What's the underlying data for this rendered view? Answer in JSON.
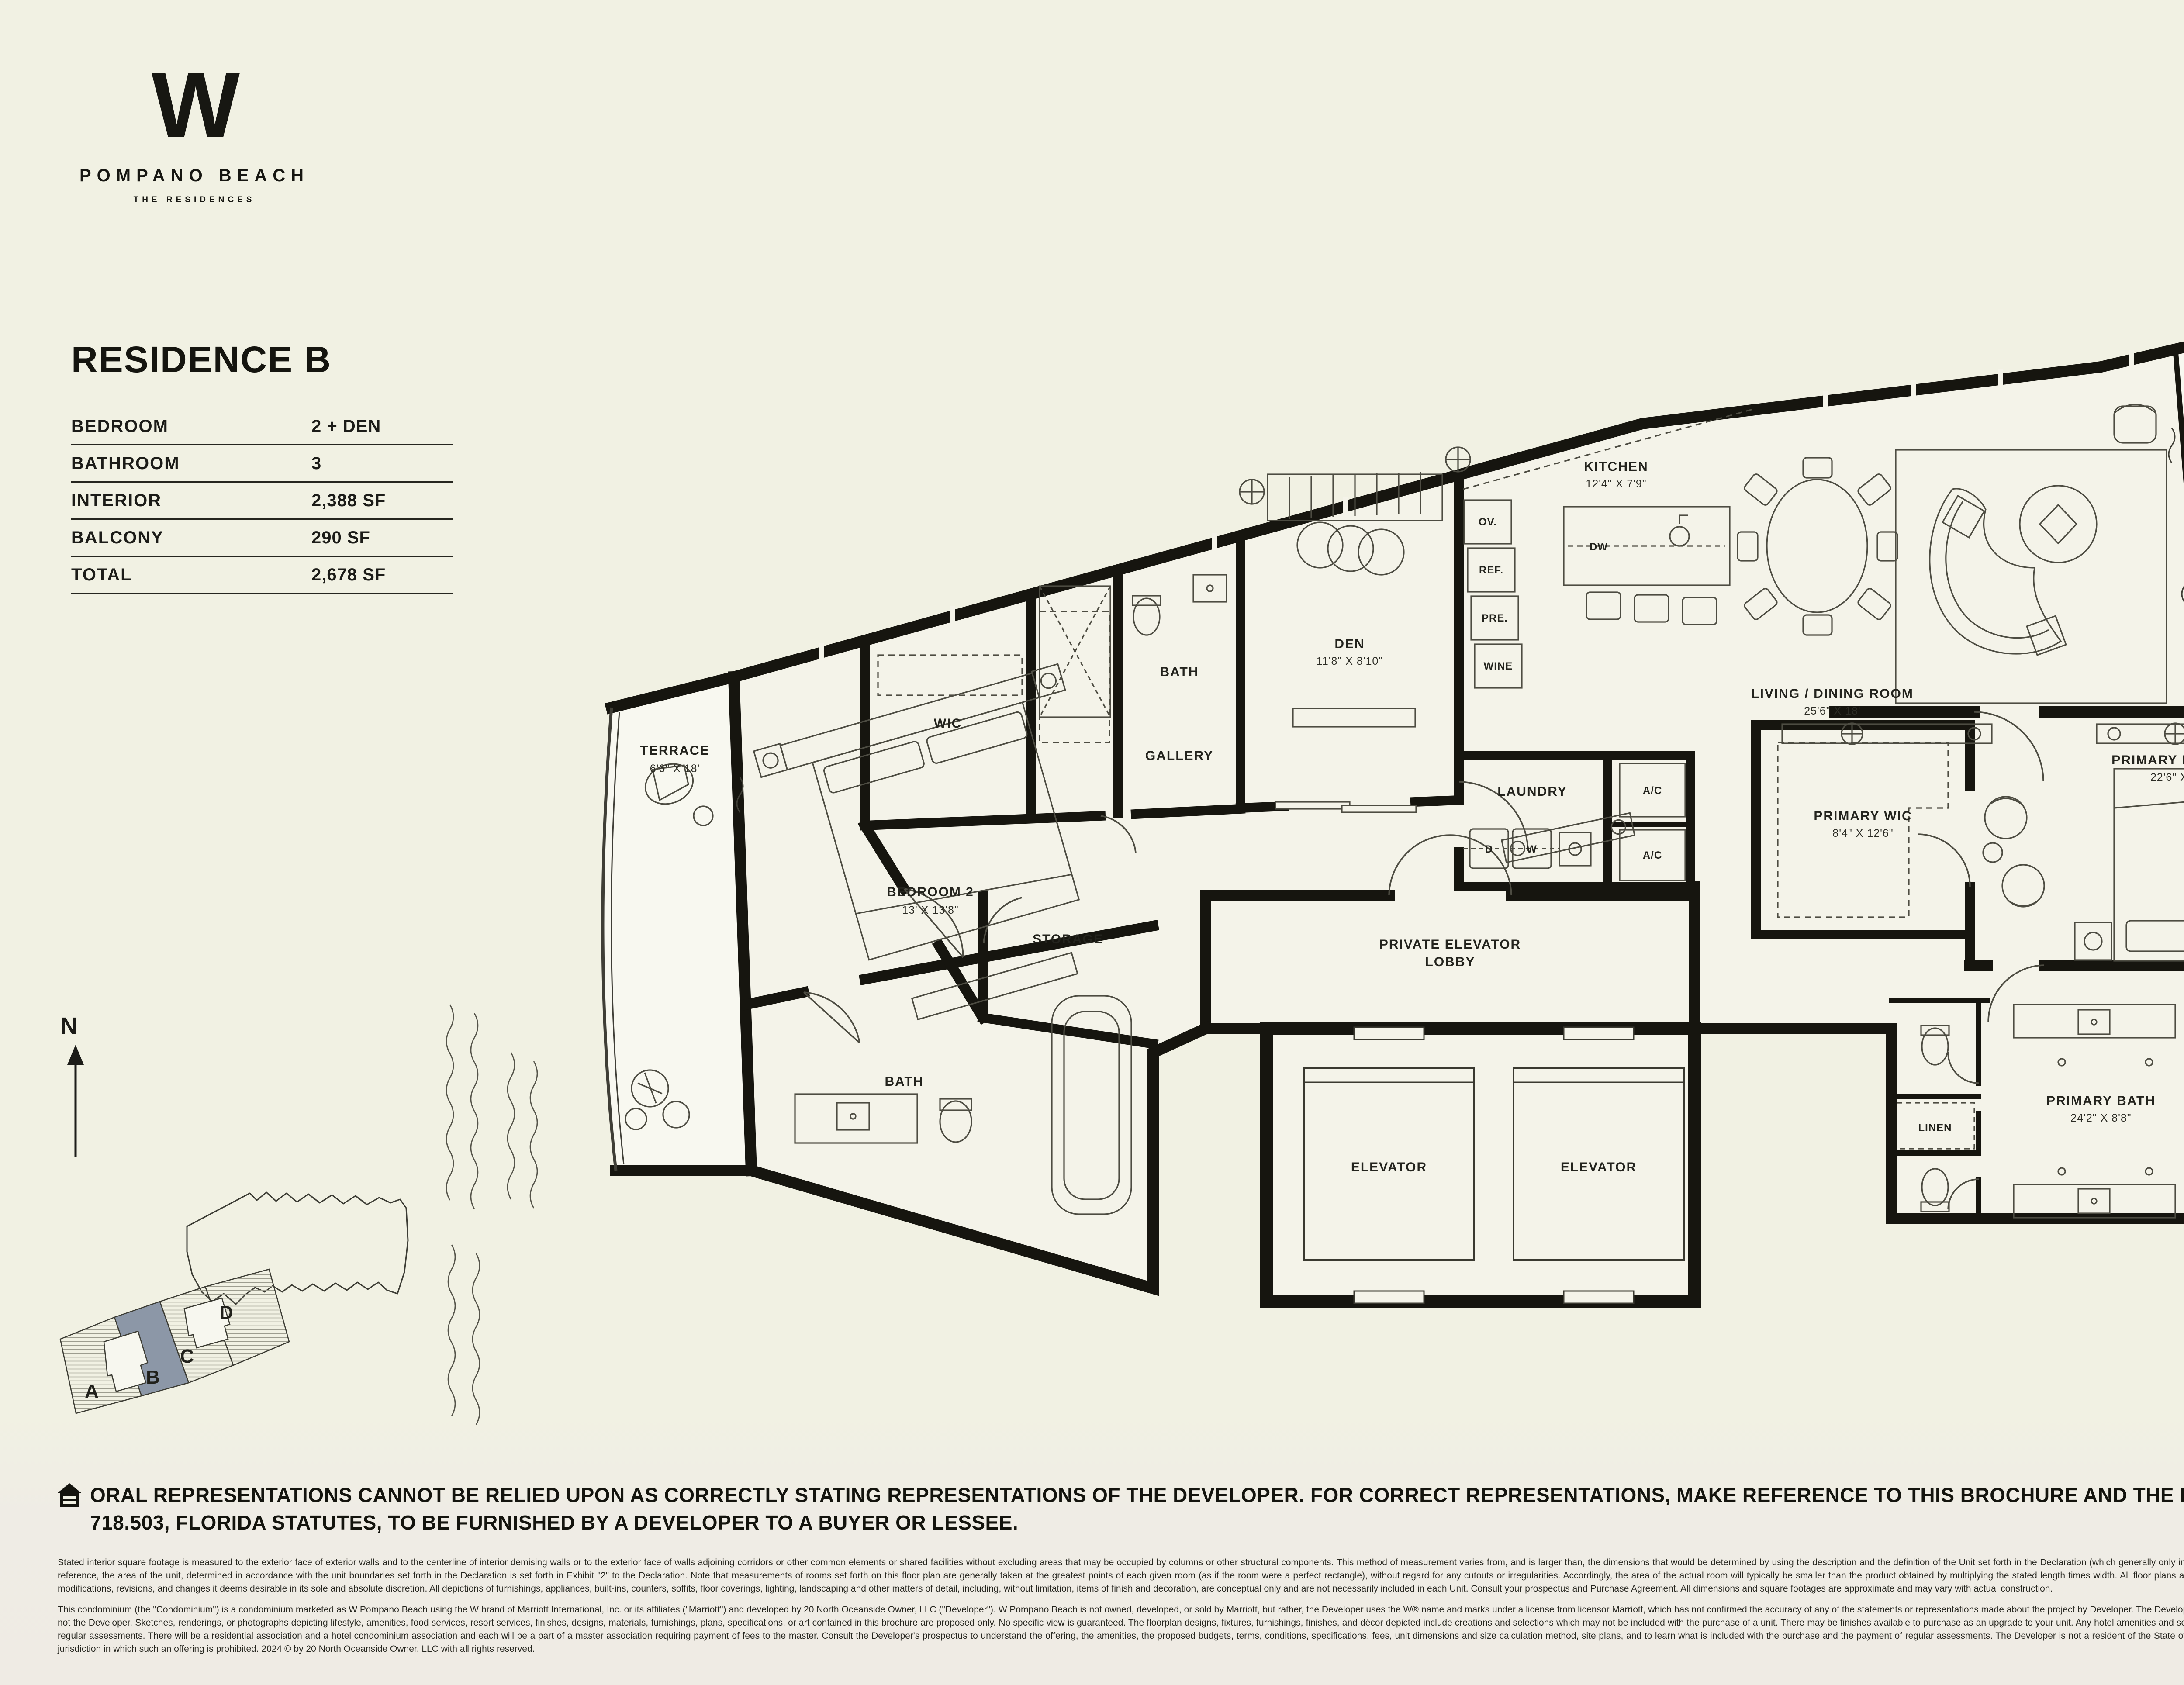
{
  "brand": {
    "mark": "W",
    "name": "POMPANO BEACH",
    "tagline": "THE RESIDENCES"
  },
  "residence": {
    "title": "RESIDENCE B",
    "specs": [
      {
        "label": "BEDROOM",
        "value": "2 + DEN"
      },
      {
        "label": "BATHROOM",
        "value": "3"
      },
      {
        "label": "INTERIOR",
        "value": "2,388 SF"
      },
      {
        "label": "BALCONY",
        "value": "290 SF"
      },
      {
        "label": "TOTAL",
        "value": "2,678 SF"
      }
    ]
  },
  "floor_plan": {
    "rooms": {
      "terrace_left": {
        "name": "TERRACE",
        "dims": "6'6\" X 18'"
      },
      "bedroom2": {
        "name": "BEDROOM 2",
        "dims": "13' X 13'8\""
      },
      "bath2": {
        "name": "BATH"
      },
      "wic": {
        "name": "WIC"
      },
      "storage": {
        "name": "STORAGE"
      },
      "gallery": {
        "name": "GALLERY"
      },
      "den_bath": {
        "name": "BATH"
      },
      "den": {
        "name": "DEN",
        "dims": "11'8\" X 8'10\""
      },
      "kitchen": {
        "name": "KITCHEN",
        "dims": "12'4\" X 7'9\""
      },
      "living_dining": {
        "name": "LIVING / DINING ROOM",
        "dims": "25'6\" X 18'"
      },
      "terrace_right": {
        "name": "TERRACE",
        "dims": "8'6\" X 21'"
      },
      "laundry": {
        "name": "LAUNDRY"
      },
      "ac1": {
        "name": "A/C"
      },
      "ac2": {
        "name": "A/C"
      },
      "lobby": {
        "line1": "PRIVATE ELEVATOR",
        "line2": "LOBBY"
      },
      "elevator1": {
        "name": "ELEVATOR"
      },
      "elevator2": {
        "name": "ELEVATOR"
      },
      "primary_wic": {
        "name": "PRIMARY WIC",
        "dims": "8'4\" X 12'6\""
      },
      "primary_bedroom": {
        "name": "PRIMARY BEDROOM",
        "dims": "22'6\" X 13'6\""
      },
      "primary_bath": {
        "name": "PRIMARY BATH",
        "dims": "24'2\" X 8'8\""
      },
      "linen": {
        "name": "LINEN"
      }
    },
    "appliances": {
      "ov": "OV.",
      "ref": "REF.",
      "pre": "PRE.",
      "wine": "WINE",
      "dw": "DW",
      "dryer": "D",
      "washer": "W"
    }
  },
  "key_plan": {
    "north_label": "N",
    "units": {
      "a": "A",
      "b": "B",
      "c": "C",
      "d": "D"
    },
    "highlighted_unit": "B",
    "highlight_color": "#8c97a7"
  },
  "disclaimer": {
    "headline": "ORAL REPRESENTATIONS CANNOT BE RELIED UPON AS CORRECTLY STATING REPRESENTATIONS OF THE DEVELOPER. FOR CORRECT REPRESENTATIONS, MAKE REFERENCE TO THIS BROCHURE AND THE DOCUMENTS REQUIRED BY SECTION 718.503, FLORIDA STATUTES, TO BE FURNISHED BY A DEVELOPER TO A BUYER OR LESSEE.",
    "fine_print_1": "Stated interior square footage is measured to the exterior face of exterior walls and to the centerline of interior demising walls or to the exterior face of walls adjoining corridors or other common elements or shared facilities without excluding areas that may be occupied by columns or other structural components. This method of measurement varies from, and is larger than, the dimensions that would be determined by using the description and the definition of the Unit set forth in the Declaration (which generally only includes the interior airspace between the perimeter walls and excludes structural components). For reference, the area of the unit, determined in accordance with the unit boundaries set forth in the Declaration is set forth in Exhibit \"2\" to the Declaration. Note that measurements of rooms set forth on this floor plan are generally taken at the greatest points of each given room (as if the room were a perfect rectangle), without regard for any cutouts or irregularities. Accordingly, the area of the actual room will typically be smaller than the product obtained by multiplying the stated length times width. All floor plans and development plans are subject to change. The Developer expressly reserves the right to make modifications, revisions, and changes it deems desirable in its sole and absolute discretion. All depictions of furnishings, appliances, built-ins, counters, soffits, floor coverings, lighting, landscaping and other matters of detail, including, without limitation, items of finish and decoration, are conceptual only and are not necessarily included in each Unit. Consult your prospectus and Purchase Agreement. All dimensions and square footages are approximate and may vary with actual construction.",
    "fine_print_2": "This condominium (the \"Condominium\") is a condominium marketed as W Pompano Beach using the W brand of Marriott International, Inc. or its affiliates (\"Marriott\") and developed by 20 North Oceanside Owner, LLC (\"Developer\"). W Pompano Beach is not owned, developed, or sold by Marriott, but rather, the Developer uses the W® name and marks under a license from licensor Marriott, which has not confirmed the accuracy of any of the statements or representations made about the project by Developer. The Developer also uses the trade names, marks, and logos of licensor, The Related Group®, which licensor is not the Developer. Sketches, renderings, or photographs depicting lifestyle, amenities, food services, resort services, finishes, designs, materials, furnishings, plans, specifications, or art contained in this brochure are proposed only. No specific view is guaranteed. The floorplan designs, fixtures, furnishings, finishes, and décor depicted include creations and selections which may not be included with the purchase of a unit. There may be finishes available to purchase as an upgrade to your unit. Any hotel amenities and services referenced in this brochure may require payment of fees by purchaser that are in addition to regular assessments. There will be a residential association and a hotel condominium association and each will be a part of a master association requiring payment of fees to the master. Consult the Developer's prospectus to understand the offering, the amenities, the proposed budgets, terms, conditions, specifications, fees, unit dimensions and size calculation method, site plans, and to learn what is included with the purchase and the payment of regular assessments. The Developer is not a resident of the State of New York, and the offering of Developer are not intended for residents of New York nor any other jurisdiction in which such an offering is prohibited. 2024 © by 20 North Oceanside Owner, LLC with all rights reserved."
  },
  "colors": {
    "ink": "#1c1c18",
    "wall": "#16150f",
    "background": "#f1f1e3",
    "unit_highlight": "#8c97a7"
  }
}
